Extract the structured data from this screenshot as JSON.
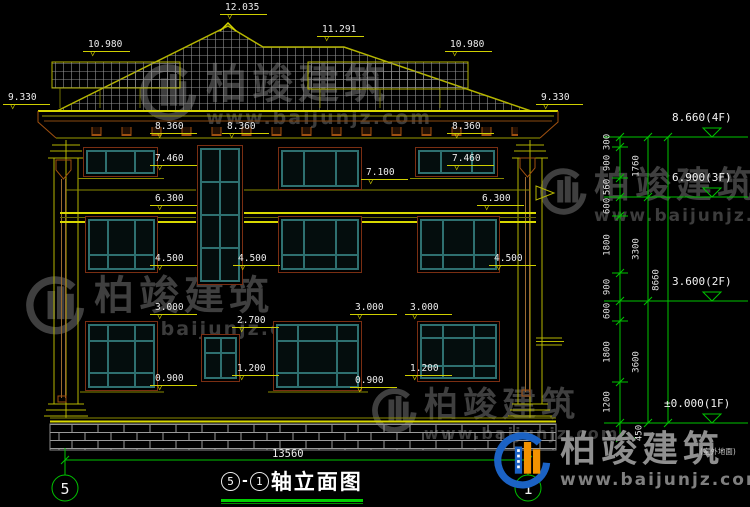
{
  "title": {
    "axis_start": "5",
    "separator": "-",
    "axis_end": "1",
    "name": "轴立面图"
  },
  "brand": {
    "name": "柏竣建筑",
    "url": "www.baijunjz.com"
  },
  "ground_note": "(室外地面)",
  "icons": {
    "level_triangle": "▽",
    "logo": "baijun-swoosh-building"
  },
  "colors": {
    "line_yellow": "#cfcf00",
    "line_green": "#00c300",
    "frame_teal": "#2e7070",
    "frame_brown": "#7a2e12",
    "watermark_gray": "#3f3f3f",
    "logo_blue": "#1b62c4",
    "logo_orange": "#f39200"
  },
  "facade_markers": [
    {
      "label": "12.035",
      "x": 225,
      "y": 3
    },
    {
      "label": "10.980",
      "x": 88,
      "y": 40
    },
    {
      "label": "11.291",
      "x": 322,
      "y": 25
    },
    {
      "label": "10.980",
      "x": 450,
      "y": 40
    },
    {
      "label": "9.330",
      "x": 8,
      "y": 93
    },
    {
      "label": "9.330",
      "x": 541,
      "y": 93
    },
    {
      "label": "8.360",
      "x": 155,
      "y": 122
    },
    {
      "label": "8.360",
      "x": 227,
      "y": 122
    },
    {
      "label": "8.360",
      "x": 452,
      "y": 122
    },
    {
      "label": "7.460",
      "x": 155,
      "y": 154
    },
    {
      "label": "7.460",
      "x": 452,
      "y": 154
    },
    {
      "label": "7.100",
      "x": 366,
      "y": 168
    },
    {
      "label": "6.300",
      "x": 155,
      "y": 194
    },
    {
      "label": "6.300",
      "x": 482,
      "y": 194
    },
    {
      "label": "4.500",
      "x": 155,
      "y": 254
    },
    {
      "label": "4.500",
      "x": 238,
      "y": 254
    },
    {
      "label": "4.500",
      "x": 494,
      "y": 254
    },
    {
      "label": "3.000",
      "x": 155,
      "y": 303
    },
    {
      "label": "3.000",
      "x": 355,
      "y": 303
    },
    {
      "label": "3.000",
      "x": 410,
      "y": 303
    },
    {
      "label": "2.700",
      "x": 237,
      "y": 316
    },
    {
      "label": "1.200",
      "x": 237,
      "y": 364
    },
    {
      "label": "1.200",
      "x": 410,
      "y": 364
    },
    {
      "label": "0.900",
      "x": 155,
      "y": 374
    },
    {
      "label": "0.900",
      "x": 355,
      "y": 376
    }
  ],
  "right_levels": [
    {
      "label": "8.660(4F)",
      "x": 672,
      "y": 112
    },
    {
      "label": "6.900(3F)",
      "x": 672,
      "y": 172
    },
    {
      "label": "3.600(2F)",
      "x": 672,
      "y": 276
    },
    {
      "label": "±0.000(1F)",
      "x": 664,
      "y": 398
    }
  ],
  "right_chain": {
    "labels": [
      {
        "v": "300",
        "x": 608,
        "y": 142
      },
      {
        "v": "900",
        "x": 608,
        "y": 163
      },
      {
        "v": "560",
        "x": 608,
        "y": 187
      },
      {
        "v": "600",
        "x": 608,
        "y": 206
      },
      {
        "v": "1800",
        "x": 608,
        "y": 245
      },
      {
        "v": "900",
        "x": 608,
        "y": 287
      },
      {
        "v": "600",
        "x": 608,
        "y": 311
      },
      {
        "v": "1800",
        "x": 608,
        "y": 352
      },
      {
        "v": "1200",
        "x": 608,
        "y": 402
      },
      {
        "v": "450",
        "x": 640,
        "y": 433
      },
      {
        "v": "1760",
        "x": 637,
        "y": 166
      },
      {
        "v": "3300",
        "x": 637,
        "y": 249
      },
      {
        "v": "3600",
        "x": 637,
        "y": 362
      },
      {
        "v": "8660",
        "x": 657,
        "y": 280
      }
    ]
  },
  "bottom": {
    "overall_width": "13560",
    "axis_left": "5",
    "axis_right": "1"
  }
}
